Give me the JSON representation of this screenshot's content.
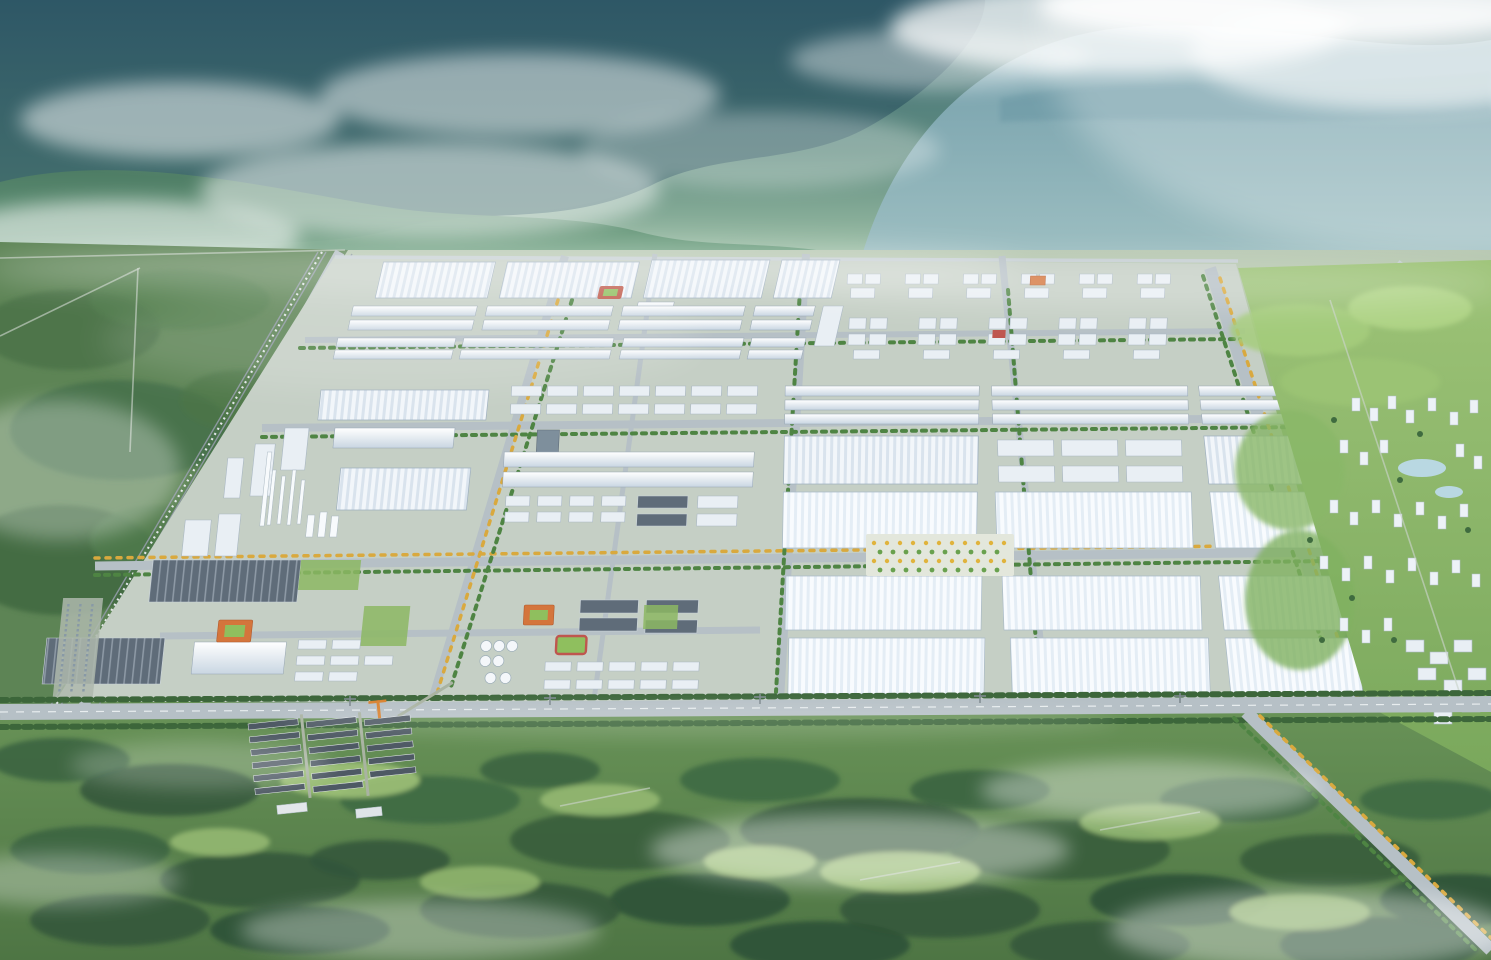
{
  "scene": {
    "title": "Aerial rendering of a master-planned industrial park at the foot of misty forested mountains",
    "description": "Bird's-eye architectural rendering: mist-wrapped blue-green mountains behind a vast industrial campus of white factory halls and warehouses arranged on a road grid with tree-lined boulevards, a chemical process plant with stacks and spherical tanks on the west side, mid-rise dormitory blocks to the north, a landscaped garden plaza at the center, a green residential district with scattered white towers and a pond to the east, a dark-roofed construction village and misty forest meadows in the foreground.",
    "atmosphere": "hazy morning light with drifting fog, sun glow from the upper right",
    "palette": {
      "sky_haze": "#cfe0d4",
      "mountain_dark": "#2e5766",
      "mountain_green": "#4e7d64",
      "mountain_haze_blue": "#7ba6b2",
      "park_ground": "#c5cfc5",
      "road": "#b6c0c6",
      "roof_white": "#f2f6fa",
      "roof_shadow": "#d9e3ed",
      "dark_roof": "#5f6c79",
      "tree_green": "#4e8443",
      "tree_autumn_yellow": "#d9a93e",
      "accent_orange": "#d4753c",
      "accent_red": "#bf564e",
      "sports_green": "#8fbf5e",
      "residential_green": "#8fb96c",
      "plaza": "#e3e7dc",
      "pond_blue": "#b9d8e2",
      "forest_dark": "#3c6440",
      "meadow_light": "#9ec178",
      "mist_white": "#ffffff"
    },
    "regions": [
      {
        "name": "mountain-backdrop",
        "label": "Forested mountains shrouded in mist and cloud"
      },
      {
        "name": "left-forest-corridor",
        "label": "Western forest belt with railway and highway corridor"
      },
      {
        "name": "upper-factory-rows",
        "label": "Northern rows of large white factory halls"
      },
      {
        "name": "dormitory-blocks",
        "label": "Clusters of mid-rise dormitory and office blocks"
      },
      {
        "name": "warehouse-grid",
        "label": "Grid of long white warehouses between tree-lined streets"
      },
      {
        "name": "chemical-plant",
        "label": "Process plant with stacks, dark halls and storage tanks"
      },
      {
        "name": "center-plaza-garden",
        "label": "Landscaped plaza with rows of yellow and green trees"
      },
      {
        "name": "residential-district",
        "label": "Eastern green district with white towers and pond"
      },
      {
        "name": "village-cluster",
        "label": "Dark-roofed low-rise construction village with crane"
      },
      {
        "name": "foreground-forest",
        "label": "Foreground forest and meadows with drifting mist"
      },
      {
        "name": "road-network",
        "label": "Boulevard grid with green and autumn-yellow street trees"
      }
    ]
  }
}
